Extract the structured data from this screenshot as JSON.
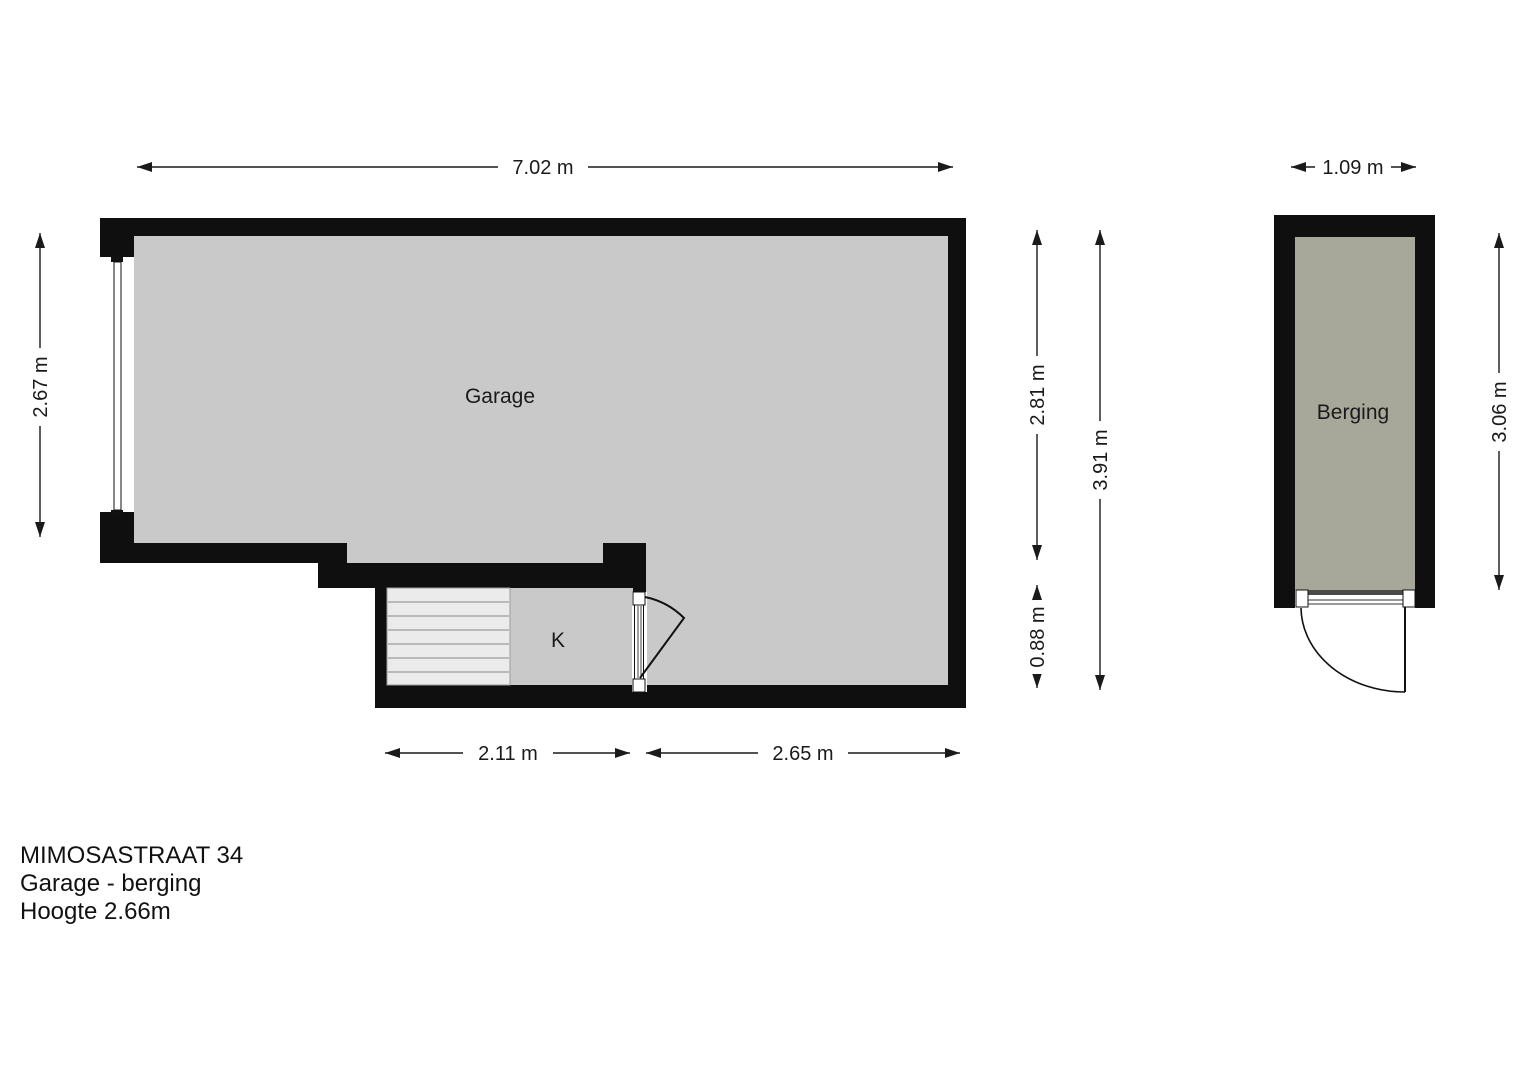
{
  "rooms": {
    "garage": {
      "label": "Garage"
    },
    "kitchen_nook": {
      "label": "K"
    },
    "storage": {
      "label": "Berging"
    }
  },
  "dimensions": {
    "garage_top_width": "7.02 m",
    "garage_left_height": "2.67 m",
    "garage_right_upper_height": "2.81 m",
    "garage_right_lower_height": "0.88 m",
    "garage_right_total_height": "3.91 m",
    "garage_bottom_left_width": "2.11 m",
    "garage_bottom_right_width": "2.65 m",
    "storage_top_width": "1.09 m",
    "storage_right_height": "3.06 m"
  },
  "title_block": {
    "address": "MIMOSASTRAAT 34",
    "subtitle": "Garage - berging",
    "height_note": "Hoogte 2.66m"
  },
  "colors": {
    "wall": "#0f0f0f",
    "garage_floor": "#c9c9c9",
    "storage_floor": "#a8a89a",
    "stairs_fill": "#ebebeb",
    "background": "#ffffff"
  }
}
